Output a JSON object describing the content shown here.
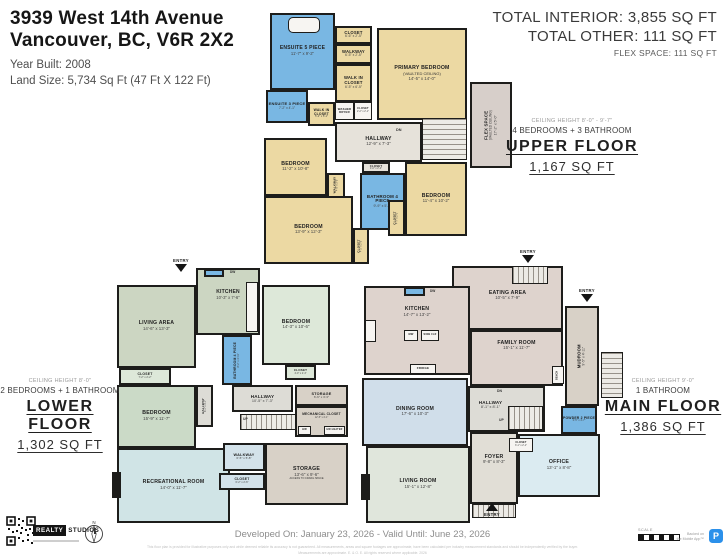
{
  "header": {
    "address_line1": "3939 West 14th Avenue",
    "address_line2": "Vancouver, BC, V6R 2X2",
    "year_built": "Year Built: 2008",
    "land_size": "Land Size: 5,734 Sq Ft (47 Ft X 122 Ft)"
  },
  "totals": {
    "interior": "TOTAL INTERIOR: 3,855 SQ FT",
    "other": "TOTAL OTHER: 111 SQ FT",
    "flex": "FLEX SPACE: 111 SQ FT"
  },
  "floor_labels": {
    "upper": {
      "ceiling": "CEILING HEIGHT 8'-0\" - 9'-7\"",
      "bedrooms": "4 BEDROOMS + 3 BATHROOM",
      "name": "UPPER FLOOR",
      "area": "1,167 SQ FT"
    },
    "lower": {
      "ceiling": "CEILING HEIGHT 8'-0\"",
      "bedrooms": "2 BEDROOMS + 1 BATHROOM",
      "name": "LOWER FLOOR",
      "area": "1,302 SQ FT"
    },
    "main": {
      "ceiling": "CEILING HEIGHT 9'-0\"",
      "bedrooms": "1 BATHROOM",
      "name": "MAIN FLOOR",
      "area": "1,386 SQ FT"
    }
  },
  "footer": {
    "developed": "Developed On: January 23, 2026 - Valid Until: June 23, 2026",
    "brand_realty": "REALTY",
    "brand_studios": "STUDIOS",
    "compass_n": "N",
    "scale_label": "SCALE",
    "app_line1": "Backed on",
    "app_line2": "the Mobile App™",
    "app_initial": "P",
    "fine_print1": "This floor plan is provided for illustrative purposes only and while deemed reliable its accuracy is not guaranteed. All measurements, areas and square footages are approximate, have been calculated per industry measurement standards and should be independently verified by the buyer.",
    "fine_print2": "Measurements are approximate. E. & O. E. All rights reserved where applicable. 2026"
  },
  "misc": {
    "entry_label": "ENTRY"
  },
  "palette": {
    "tan": "#ecd9a3",
    "blue": "#79b7e3",
    "hgray": "#e6e2da",
    "mauvef": "#d7cfca",
    "sage": "#ccd6c2",
    "mint": "#dde8d9",
    "green2": "#cbdac7",
    "recblue": "#d0e4e6",
    "wblue": "#d3e2ea",
    "lgray": "#dddcd6",
    "taupe": "#d8d1c7",
    "mmauve": "#ded3cd",
    "dblue": "#d0deea",
    "lgreen": "#e0e6dc",
    "office": "#dbebf1",
    "foyer": "#e1ded6"
  },
  "floors": {
    "upper": [
      {
        "t": "room",
        "id": "ensuite-5-piece",
        "n": "ENSUITE 5 PIECE",
        "d": "11'-7\" x 9'-2\"",
        "x": 270,
        "y": 13,
        "w": 65,
        "h": 77,
        "f": "blue",
        "c": "tile",
        "fs": 5
      },
      {
        "t": "box",
        "id": "bathtub",
        "x": 288,
        "y": 17,
        "w": 32,
        "h": 16,
        "c": "round"
      },
      {
        "t": "room",
        "id": "closet-top",
        "n": "CLOSET",
        "d": "6'-6\" x 2'-5\"",
        "x": 335,
        "y": 26,
        "w": 37,
        "h": 18,
        "f": "tan",
        "fs": 4.2
      },
      {
        "t": "room",
        "id": "walkway-top",
        "n": "WALKWAY",
        "d": "6'-5\" x 2'-5\"",
        "x": 335,
        "y": 44,
        "w": 37,
        "h": 20,
        "f": "tan",
        "fs": 4.2
      },
      {
        "t": "room",
        "id": "walk-in-closet",
        "n": "WALK IN CLOSET",
        "d": "6'-5\" x 6'-5\"",
        "x": 335,
        "y": 64,
        "w": 37,
        "h": 38,
        "f": "tan",
        "fs": 4.2
      },
      {
        "t": "room",
        "id": "primary-bedroom",
        "n": "PRIMARY BEDROOM",
        "s": "(VAULTED CEILING)",
        "d": "14'-5\" x 14'-0\"",
        "x": 377,
        "y": 28,
        "w": 90,
        "h": 92,
        "f": "tan",
        "c": "vault"
      },
      {
        "t": "room",
        "id": "ensuite-3-piece",
        "n": "ENSUITE 3 PIECE",
        "d": "7'-2\" x 4'-1\"",
        "x": 266,
        "y": 90,
        "w": 42,
        "h": 33,
        "f": "blue",
        "c": "tile",
        "fs": 4
      },
      {
        "t": "room",
        "id": "walk-in-closet-2",
        "n": "WALK IN CLOSET",
        "d": "5'-2\" x 5'-1\"",
        "x": 308,
        "y": 102,
        "w": 27,
        "h": 24,
        "f": "tan",
        "fs": 3.4
      },
      {
        "t": "box",
        "id": "washer-dryer",
        "n": "WASHER DRYER",
        "x": 335,
        "y": 102,
        "w": 19,
        "h": 18,
        "fs": 2.8
      },
      {
        "t": "box",
        "id": "closet-box",
        "n": "CLOSET",
        "d": "2'-2\" x 2'-1\"",
        "x": 354,
        "y": 102,
        "w": 18,
        "h": 18,
        "fs": 2.6
      },
      {
        "t": "room",
        "id": "hallway-upper",
        "n": "HALLWAY",
        "d": "12'-9\" x 7'-3\"",
        "x": 335,
        "y": 122,
        "w": 87,
        "h": 40,
        "f": "hgray",
        "fs": 5.2
      },
      {
        "t": "stairs",
        "id": "stairs-upper",
        "x": 422,
        "y": 118,
        "w": 45,
        "h": 42,
        "c": "stairs-h"
      },
      {
        "t": "text",
        "id": "dn-label-upper",
        "n": "DN",
        "x": 396,
        "y": 128,
        "fs": 3.8
      },
      {
        "t": "room",
        "id": "closet-hall",
        "n": "CLOSET",
        "d": "4'-0\" x 2'-4\"",
        "x": 362,
        "y": 162,
        "w": 28,
        "h": 11,
        "f": "hgray",
        "fs": 2.8
      },
      {
        "t": "room",
        "id": "walkway-2",
        "n": "WALKWAY",
        "d": "4'-5\" x 3'-5\"",
        "x": 327,
        "y": 173,
        "w": 18,
        "h": 25,
        "f": "tan",
        "r": 1,
        "fs": 3
      },
      {
        "t": "room",
        "id": "bathroom-4-piece-upper",
        "n": "BATHROOM 4 PIECE",
        "d": "9'-9\" x 5'-8\"",
        "x": 360,
        "y": 173,
        "w": 45,
        "h": 57,
        "f": "blue",
        "c": "tile",
        "fs": 4.4
      },
      {
        "t": "room",
        "id": "bedroom-1",
        "n": "BEDROOM",
        "d": "11'-2\" x 10'-8\"",
        "x": 264,
        "y": 138,
        "w": 63,
        "h": 58,
        "f": "tan"
      },
      {
        "t": "room",
        "id": "bedroom-2",
        "n": "BEDROOM",
        "d": "13'-9\" x 12'-3\"",
        "x": 264,
        "y": 196,
        "w": 89,
        "h": 68,
        "f": "tan"
      },
      {
        "t": "room",
        "id": "closet-rot-1",
        "n": "CLOSET",
        "d": "4'-2\" x 2'-5\"",
        "x": 353,
        "y": 228,
        "w": 16,
        "h": 36,
        "f": "tan",
        "r": 1,
        "fs": 3
      },
      {
        "t": "room",
        "id": "bedroom-3",
        "n": "BEDROOM",
        "d": "11'-4\" x 10'-2\"",
        "x": 405,
        "y": 162,
        "w": 62,
        "h": 74,
        "f": "tan"
      },
      {
        "t": "room",
        "id": "closet-rot-2",
        "n": "CLOSET",
        "d": "4'-7\" x 2'-0\"",
        "x": 388,
        "y": 200,
        "w": 17,
        "h": 36,
        "f": "tan",
        "r": 1,
        "fs": 3
      },
      {
        "t": "room",
        "id": "flex-space",
        "n": "FLEX SPACE",
        "s": "(VAULTED CEILING)",
        "d": "17'-2\" x 5'-0\"",
        "x": 470,
        "y": 82,
        "w": 42,
        "h": 86,
        "f": "mauvef",
        "r": 1,
        "fs": 4.4
      }
    ],
    "lower": [
      {
        "t": "entry",
        "id": "entry-lower",
        "x": 181,
        "y": 258,
        "dir": "down"
      },
      {
        "t": "room",
        "id": "kitchen-lower",
        "n": "KITCHEN",
        "d": "10'-3\" x 7'-6\"",
        "x": 196,
        "y": 268,
        "w": 64,
        "h": 67,
        "f": "sage",
        "fs": 5,
        "ly": -6
      },
      {
        "t": "sink",
        "id": "sink-lower",
        "x": 204,
        "y": 269,
        "w": 20,
        "h": 8
      },
      {
        "t": "text",
        "id": "dw-lower",
        "n": "DW",
        "x": 230,
        "y": 270,
        "fs": 3.2
      },
      {
        "t": "box",
        "id": "counter-lower",
        "x": 246,
        "y": 282,
        "w": 12,
        "h": 50
      },
      {
        "t": "room",
        "id": "living-area",
        "n": "LIVING AREA",
        "d": "14'-6\" x 13'-3\"",
        "x": 117,
        "y": 285,
        "w": 79,
        "h": 83,
        "f": "sage"
      },
      {
        "t": "room",
        "id": "bedroom-a",
        "n": "BEDROOM",
        "d": "14'-3\" x 10'-6\"",
        "x": 262,
        "y": 285,
        "w": 68,
        "h": 80,
        "f": "mint"
      },
      {
        "t": "room",
        "id": "closet-a",
        "n": "CLOSET",
        "d": "4'-0\" x 2'-4\"",
        "x": 285,
        "y": 365,
        "w": 31,
        "h": 15,
        "f": "mint",
        "fs": 3
      },
      {
        "t": "room",
        "id": "bathroom-4-piece-lower",
        "n": "BATHROOM 4 PIECE",
        "d": "8'-2\" x 4'-11\"",
        "x": 222,
        "y": 335,
        "w": 30,
        "h": 50,
        "f": "blue",
        "c": "tile",
        "r": 1,
        "fs": 3.4
      },
      {
        "t": "room",
        "id": "closet-b",
        "n": "CLOSET",
        "d": "7'-2\" x 2'-2\"",
        "x": 119,
        "y": 368,
        "w": 52,
        "h": 17,
        "f": "mint",
        "fs": 3.4
      },
      {
        "t": "room",
        "id": "hallway-small-lower",
        "n": "HALLWAY",
        "d": "8'-1\" x 3'-1\"",
        "x": 196,
        "y": 385,
        "w": 17,
        "h": 42,
        "f": "lgray",
        "r": 1,
        "fs": 3
      },
      {
        "t": "room",
        "id": "bedroom-b",
        "n": "BEDROOM",
        "d": "15'-9\" x 11'-7\"",
        "x": 117,
        "y": 385,
        "w": 79,
        "h": 63,
        "f": "green2"
      },
      {
        "t": "room",
        "id": "recreational-room",
        "n": "RECREATIONAL ROOM",
        "d": "14'-0\" x 11'-7\"",
        "x": 117,
        "y": 448,
        "w": 113,
        "h": 75,
        "f": "recblue"
      },
      {
        "t": "solid",
        "id": "fireplace-lower",
        "x": 112,
        "y": 472,
        "w": 9,
        "h": 26
      },
      {
        "t": "room",
        "id": "hallway-lower",
        "n": "HALLWAY",
        "d": "10'-5\" x 7'-3\"",
        "x": 232,
        "y": 385,
        "w": 61,
        "h": 27,
        "f": "lgray",
        "fs": 4.6
      },
      {
        "t": "stairs",
        "id": "stairs-lower",
        "x": 240,
        "y": 414,
        "w": 70,
        "h": 16,
        "c": "stairs-v"
      },
      {
        "t": "text",
        "id": "up-lower",
        "n": "UP",
        "x": 243,
        "y": 417,
        "fs": 3.4
      },
      {
        "t": "room",
        "id": "storage-small",
        "n": "STORAGE",
        "d": "6'-6\" x 3'-3\"",
        "x": 295,
        "y": 385,
        "w": 53,
        "h": 21,
        "f": "taupe",
        "fs": 3.8
      },
      {
        "t": "room",
        "id": "mechanical-closet",
        "n": "MECHANICAL CLOSET",
        "d": "12'-5\" x 4'-1\"",
        "x": 295,
        "y": 406,
        "w": 53,
        "h": 31,
        "f": "taupe",
        "fs": 3.2,
        "ly": -5
      },
      {
        "t": "box",
        "id": "hw",
        "n": "HW",
        "x": 298,
        "y": 426,
        "w": 13,
        "h": 9,
        "fs": 2.6
      },
      {
        "t": "box",
        "id": "hw-heater",
        "n": "HW HEATER",
        "x": 324,
        "y": 426,
        "w": 21,
        "h": 9,
        "fs": 2.4
      },
      {
        "t": "room",
        "id": "storage-big",
        "n": "STORAGE",
        "d": "13'-6\" x 9'-6\"",
        "s2": "ACCESS TO CRAWL SPACE",
        "x": 265,
        "y": 443,
        "w": 83,
        "h": 62,
        "f": "taupe"
      },
      {
        "t": "room",
        "id": "walkway-lower",
        "n": "WALKWAY",
        "d": "6'-5\" x 5'-8\"",
        "x": 223,
        "y": 443,
        "w": 42,
        "h": 28,
        "f": "wblue",
        "fs": 3.8
      },
      {
        "t": "room",
        "id": "closet-c",
        "n": "CLOSET",
        "d": "6'-2\" x 2'-6\"",
        "x": 219,
        "y": 473,
        "w": 46,
        "h": 17,
        "f": "wblue",
        "fs": 3.4
      }
    ],
    "main": [
      {
        "t": "entry",
        "id": "entry-main-top",
        "x": 528,
        "y": 249,
        "dir": "down"
      },
      {
        "t": "room",
        "id": "eating-area",
        "n": "EATING AREA",
        "d": "10'-5\" x 7'-9\"",
        "x": 452,
        "y": 266,
        "w": 111,
        "h": 64,
        "f": "mmauve",
        "ly": -2
      },
      {
        "t": "porch",
        "id": "porch-top",
        "x": 512,
        "y": 266,
        "w": 36,
        "h": 18,
        "c": "stairs-v"
      },
      {
        "t": "room",
        "id": "kitchen-main",
        "n": "KITCHEN",
        "d": "14'-7\" x 13'-2\"",
        "x": 364,
        "y": 286,
        "w": 106,
        "h": 89,
        "f": "mmauve",
        "ly": -18
      },
      {
        "t": "sink",
        "id": "sink-main",
        "x": 404,
        "y": 287,
        "w": 21,
        "h": 9
      },
      {
        "t": "text",
        "id": "dw-main",
        "n": "DW",
        "x": 430,
        "y": 289,
        "fs": 3.2
      },
      {
        "t": "box",
        "id": "stove",
        "x": 365,
        "y": 320,
        "w": 11,
        "h": 22
      },
      {
        "t": "box",
        "id": "microwave",
        "n": "MW",
        "x": 404,
        "y": 330,
        "w": 14,
        "h": 11,
        "fs": 2.6
      },
      {
        "t": "box",
        "id": "wine-cooler",
        "n": "WINE CLR",
        "x": 421,
        "y": 330,
        "w": 18,
        "h": 11,
        "fs": 2.3
      },
      {
        "t": "box",
        "id": "fridge",
        "n": "FRIDGE",
        "x": 410,
        "y": 364,
        "w": 26,
        "h": 10,
        "fs": 3
      },
      {
        "t": "room",
        "id": "family-room",
        "n": "FAMILY ROOM",
        "d": "15'-1\" x 11'-7\"",
        "x": 470,
        "y": 330,
        "w": 93,
        "h": 56,
        "f": "mmauve",
        "ly": -12
      },
      {
        "t": "entry",
        "id": "entry-main-right",
        "x": 587,
        "y": 288,
        "dir": "down"
      },
      {
        "t": "room",
        "id": "mudroom",
        "n": "MUDROOM",
        "d": "9'-5\" x 4'-11\"",
        "x": 565,
        "y": 306,
        "w": 34,
        "h": 100,
        "f": "taupe",
        "r": 1,
        "fs": 4.2
      },
      {
        "t": "box",
        "id": "bench",
        "n": "BENCH",
        "x": 552,
        "y": 366,
        "w": 12,
        "h": 18,
        "fs": 2.3,
        "r": 1
      },
      {
        "t": "porch",
        "id": "porch-right",
        "x": 601,
        "y": 352,
        "w": 22,
        "h": 46,
        "c": "stairs-h"
      },
      {
        "t": "room",
        "id": "hallway-main",
        "n": "HALLWAY",
        "d": "8'-1\" x 8'-1\"",
        "x": 468,
        "y": 386,
        "w": 77,
        "h": 46,
        "f": "lgray",
        "lx": -16,
        "ly": -4,
        "fs": 4.6
      },
      {
        "t": "text",
        "id": "dn-main",
        "n": "DN",
        "x": 497,
        "y": 389,
        "fs": 3.4
      },
      {
        "t": "stairs",
        "id": "stairs-main",
        "x": 508,
        "y": 406,
        "w": 35,
        "h": 24,
        "c": "stairs-v"
      },
      {
        "t": "text",
        "id": "up-main",
        "n": "UP",
        "x": 499,
        "y": 418,
        "fs": 3.4
      },
      {
        "t": "room",
        "id": "dining-room",
        "n": "DINING ROOM",
        "d": "17'-6\" x 10'-3\"",
        "x": 362,
        "y": 378,
        "w": 106,
        "h": 68,
        "f": "dblue"
      },
      {
        "t": "room",
        "id": "living-room",
        "n": "LIVING ROOM",
        "d": "15'-1\" x 12'-8\"",
        "x": 366,
        "y": 446,
        "w": 104,
        "h": 77,
        "f": "lgreen"
      },
      {
        "t": "solid",
        "id": "fireplace-main",
        "x": 361,
        "y": 474,
        "w": 9,
        "h": 26
      },
      {
        "t": "room",
        "id": "foyer",
        "n": "FOYER",
        "d": "9'-8\" x 8'-3\"",
        "x": 470,
        "y": 432,
        "w": 48,
        "h": 72,
        "f": "foyer",
        "ly": -8
      },
      {
        "t": "room",
        "id": "powder-2-piece",
        "n": "POWDER 2 PIECE",
        "d": "3'-5\" x 4'-7\"",
        "x": 561,
        "y": 406,
        "w": 36,
        "h": 28,
        "f": "blue",
        "c": "tile",
        "fs": 3.4
      },
      {
        "t": "room",
        "id": "office",
        "n": "OFFICE",
        "d": "13'-1\" x 8'-8\"",
        "x": 518,
        "y": 434,
        "w": 82,
        "h": 63,
        "f": "office"
      },
      {
        "t": "box",
        "id": "closet-main",
        "n": "CLOSET",
        "d": "3'-1\" x 2'-1\"",
        "x": 509,
        "y": 438,
        "w": 24,
        "h": 14,
        "fs": 2.5
      },
      {
        "t": "porch",
        "id": "porch-bottom",
        "x": 472,
        "y": 504,
        "w": 44,
        "h": 14,
        "c": "stairs-v"
      },
      {
        "t": "entry",
        "id": "entry-main-bottom",
        "x": 492,
        "y": 503,
        "dir": "up"
      }
    ]
  }
}
